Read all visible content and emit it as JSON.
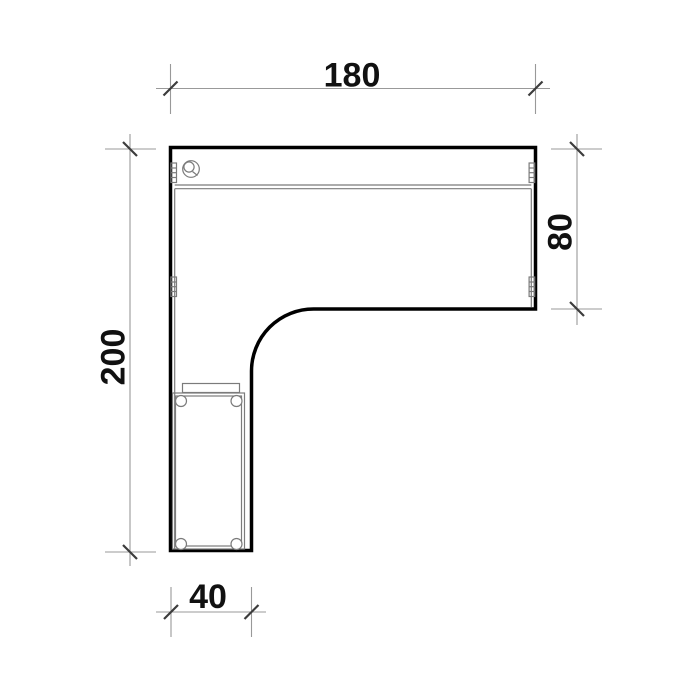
{
  "drawing": {
    "kind": "technical plan drawing",
    "subject": "l-shaped-corner-desk-top-view",
    "dimensions": {
      "top": {
        "label": "180",
        "value": 180,
        "orientation": "horizontal"
      },
      "right": {
        "label": "80",
        "value": 80,
        "orientation": "vertical"
      },
      "left": {
        "label": "200",
        "value": 200,
        "orientation": "vertical"
      },
      "bottom": {
        "label": "40",
        "value": 40,
        "orientation": "horizontal"
      }
    },
    "colors": {
      "background": "#ffffff",
      "outline": "#000000",
      "detail": "#7b7b7b",
      "dimension": "#999999",
      "tick": "#3c3c3c",
      "text": "#111111"
    }
  }
}
